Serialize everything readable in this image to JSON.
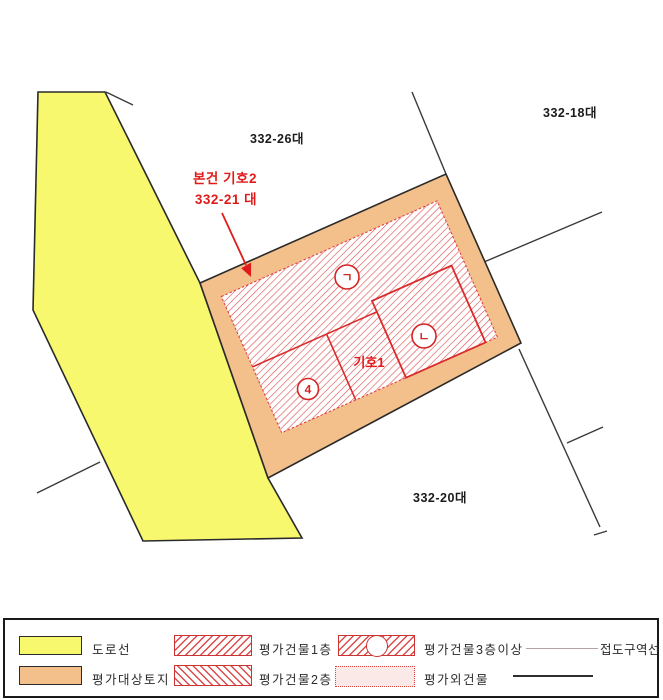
{
  "map": {
    "parcel_labels": [
      {
        "text": "332-26대"
      },
      {
        "text": "332-18대"
      },
      {
        "text": "332-20대"
      }
    ],
    "subject_annotation": {
      "line1": "본건 기호2",
      "line2": "332-21 대"
    },
    "building_unit_label": "기호1",
    "building_markers": [
      {
        "glyph": "ㄱ"
      },
      {
        "glyph": "ㄴ"
      },
      {
        "glyph": "4"
      }
    ],
    "colors": {
      "road": "#f8f86e",
      "subject_land": "#f3bf8b",
      "building_hatch": "#e05050",
      "building_outline": "#d92b2b",
      "annotation_red": "#e11b1b",
      "boundary_line": "#3a3a3a"
    }
  },
  "legend": {
    "items": [
      {
        "label": "도로선",
        "type": "road-line"
      },
      {
        "label": "평가대상토지",
        "type": "subject-land"
      },
      {
        "label": "평가건물1층",
        "type": "appraised-building-1f"
      },
      {
        "label": "평가건물2층",
        "type": "appraised-building-2f"
      },
      {
        "label": "평가건물3층이상",
        "type": "appraised-building-3f-plus"
      },
      {
        "label": "평가외건물",
        "type": "excluded-building"
      },
      {
        "label": "접도구역선",
        "type": "road-zone-line"
      },
      {
        "label": "",
        "type": "boundary-line"
      }
    ]
  }
}
